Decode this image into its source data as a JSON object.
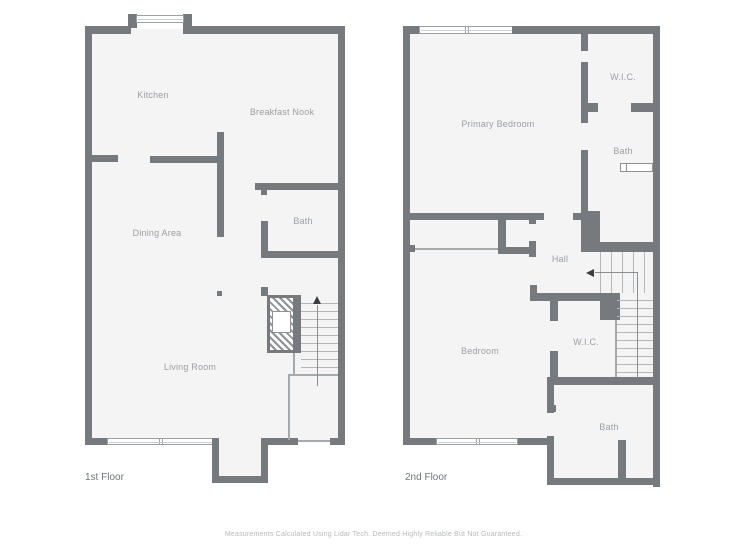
{
  "floors": [
    {
      "label": "1st Floor",
      "rooms": {
        "kitchen": "Kitchen",
        "breakfast_nook": "Breakfast Nook",
        "dining_area": "Dining Area",
        "bath": "Bath",
        "living_room": "Living Room"
      }
    },
    {
      "label": "2nd Floor",
      "rooms": {
        "primary_bedroom": "Primary Bedroom",
        "wic_upper": "W.I.C.",
        "bath_upper": "Bath",
        "hall": "Hall",
        "bedroom": "Bedroom",
        "wic_lower": "W.I.C.",
        "bath_lower": "Bath"
      }
    }
  ],
  "disclaimer": "Measurements Calculated Using Lidar Tech. Deemed Highly Reliable But Not Guaranteed.",
  "colors": {
    "wall": "#76797d",
    "floor_fill": "#f4f4f5",
    "label_text": "#9b9ea2",
    "thin_line": "#a6a9ac"
  }
}
